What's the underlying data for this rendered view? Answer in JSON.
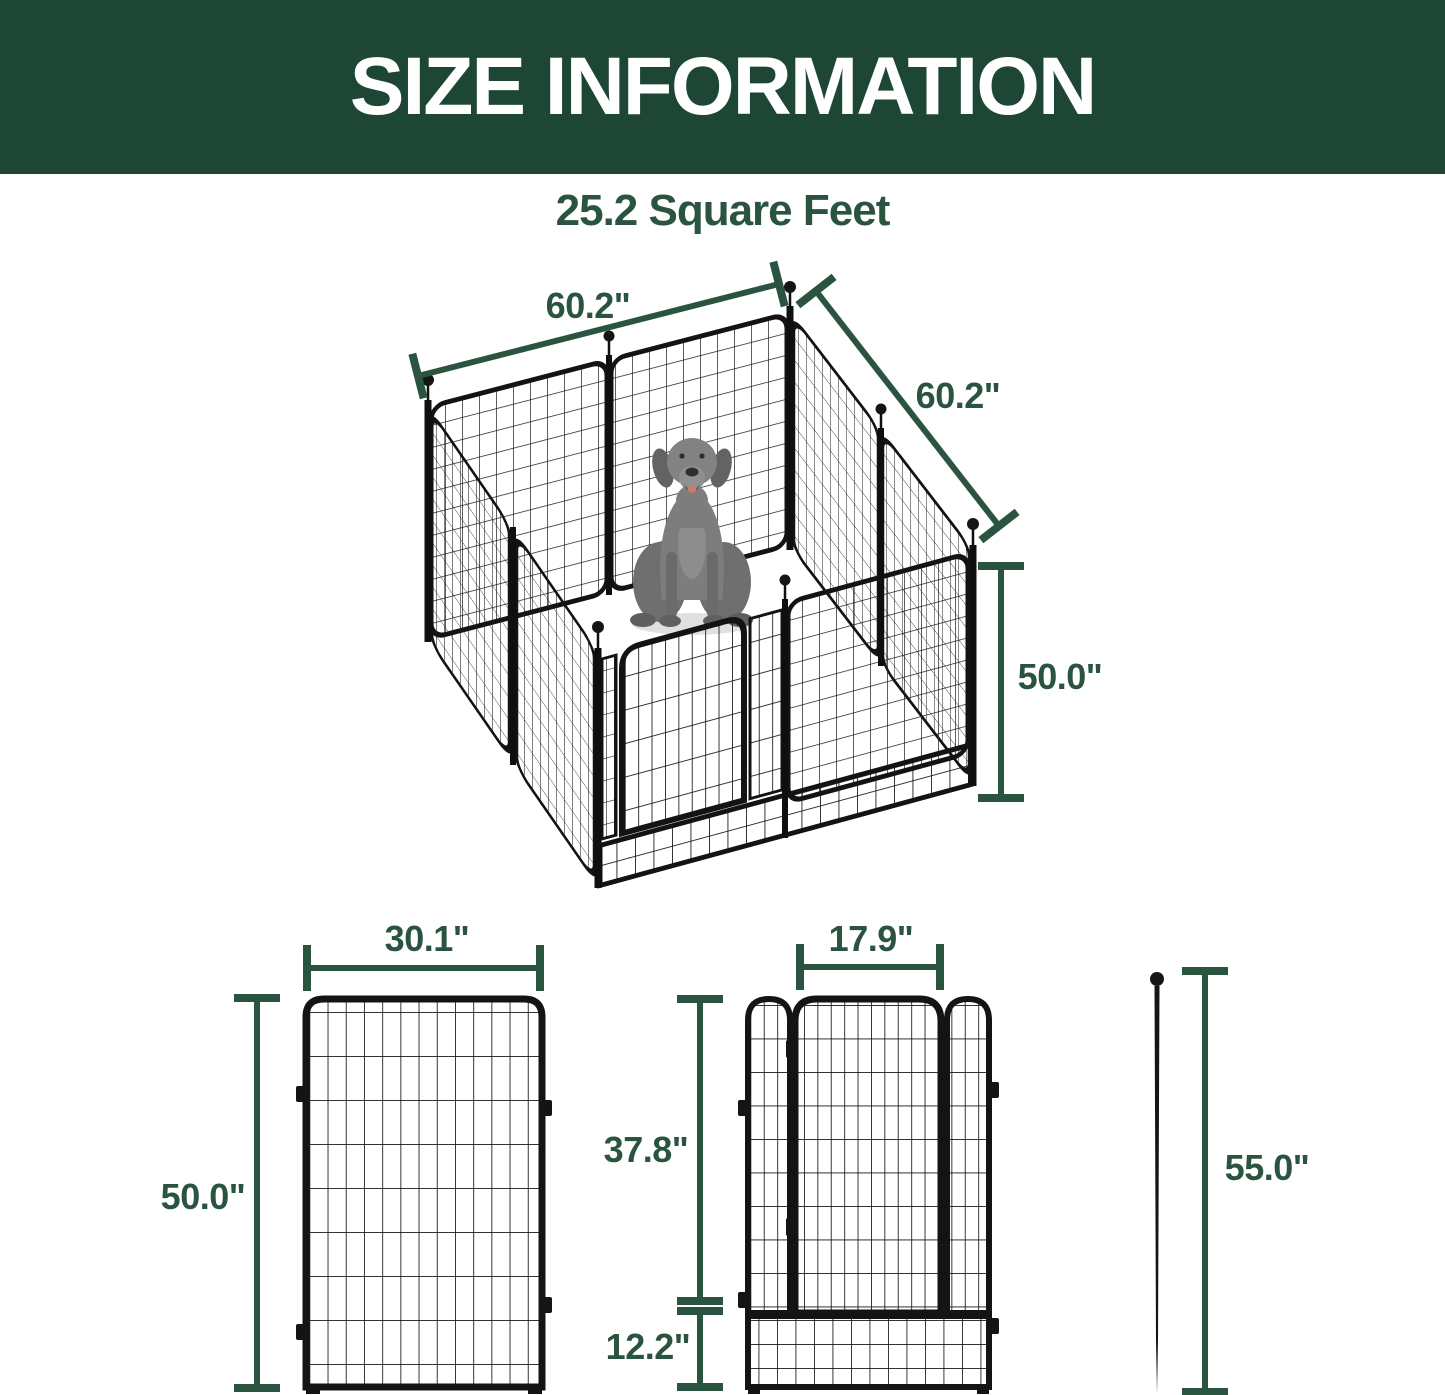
{
  "banner": {
    "title": "SIZE INFORMATION",
    "bg_color": "#1e4634",
    "text_color": "#ffffff"
  },
  "subtitle": {
    "text": "25.2 Square Feet"
  },
  "colors": {
    "accent_green": "#2a5440",
    "metal_black": "#141414",
    "dog_gray": "#7d7d7d"
  },
  "iso": {
    "width_left": "60.2\"",
    "width_right": "60.2\"",
    "height": "50.0\""
  },
  "front": {
    "panel_width": "30.1\"",
    "panel_height": "50.0\"",
    "gate_width": "17.9\"",
    "gate_upper_height": "37.8\"",
    "gate_bottom_height": "12.2\"",
    "stake_height": "55.0\""
  }
}
